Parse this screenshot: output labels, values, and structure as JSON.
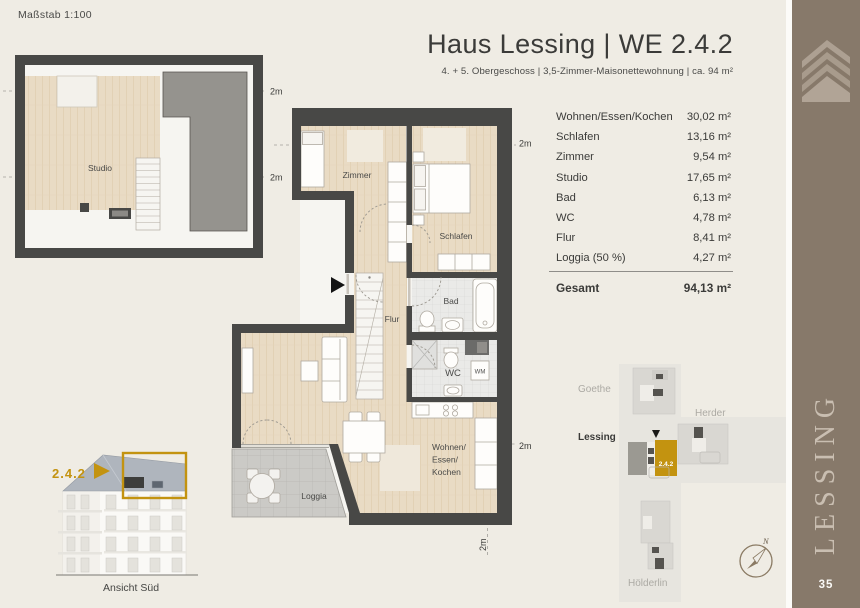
{
  "scale_label": "Maßstab 1:100",
  "header": {
    "title": "Haus Lessing | WE 2.4.2",
    "subtitle": "4. + 5. Obergeschoss | 3,5-Zimmer-Maisonettewohnung | ca. 94 m²"
  },
  "area_table": {
    "rows": [
      {
        "label": "Wohnen/Essen/Kochen",
        "value": "30,02 m²"
      },
      {
        "label": "Schlafen",
        "value": "13,16 m²"
      },
      {
        "label": "Zimmer",
        "value": "9,54 m²"
      },
      {
        "label": "Studio",
        "value": "17,65 m²"
      },
      {
        "label": "Bad",
        "value": "6,13 m²"
      },
      {
        "label": "WC",
        "value": "4,78 m²"
      },
      {
        "label": "Flur",
        "value": "8,41 m²"
      },
      {
        "label": "Loggia (50 %)",
        "value": "4,27 m²"
      }
    ],
    "total_label": "Gesamt",
    "total_value": "94,13 m²"
  },
  "plans": {
    "height_marker": "2m",
    "upper": {
      "studio": "Studio"
    },
    "main": {
      "zimmer": "Zimmer",
      "schlafen": "Schlafen",
      "bad": "Bad",
      "wc": "WC",
      "wm": "WM",
      "flur": "Flur",
      "wohnen": "Wohnen/",
      "essen": "Essen/",
      "kochen": "Kochen",
      "loggia": "Loggia"
    }
  },
  "elevation": {
    "unit": "2.4.2",
    "caption": "Ansicht Süd"
  },
  "site_plan": {
    "labels": {
      "goethe": "Goethe",
      "herder": "Herder",
      "lessing": "Lessing",
      "hoelderlin": "Hölderlin"
    },
    "unit": "2.4.2",
    "north": "N"
  },
  "sidebar": {
    "name": "LESSING",
    "page": "35"
  },
  "colors": {
    "accent_gold": "#C39310",
    "wall": "#484846",
    "sidebar_taupe": "#87796A"
  }
}
